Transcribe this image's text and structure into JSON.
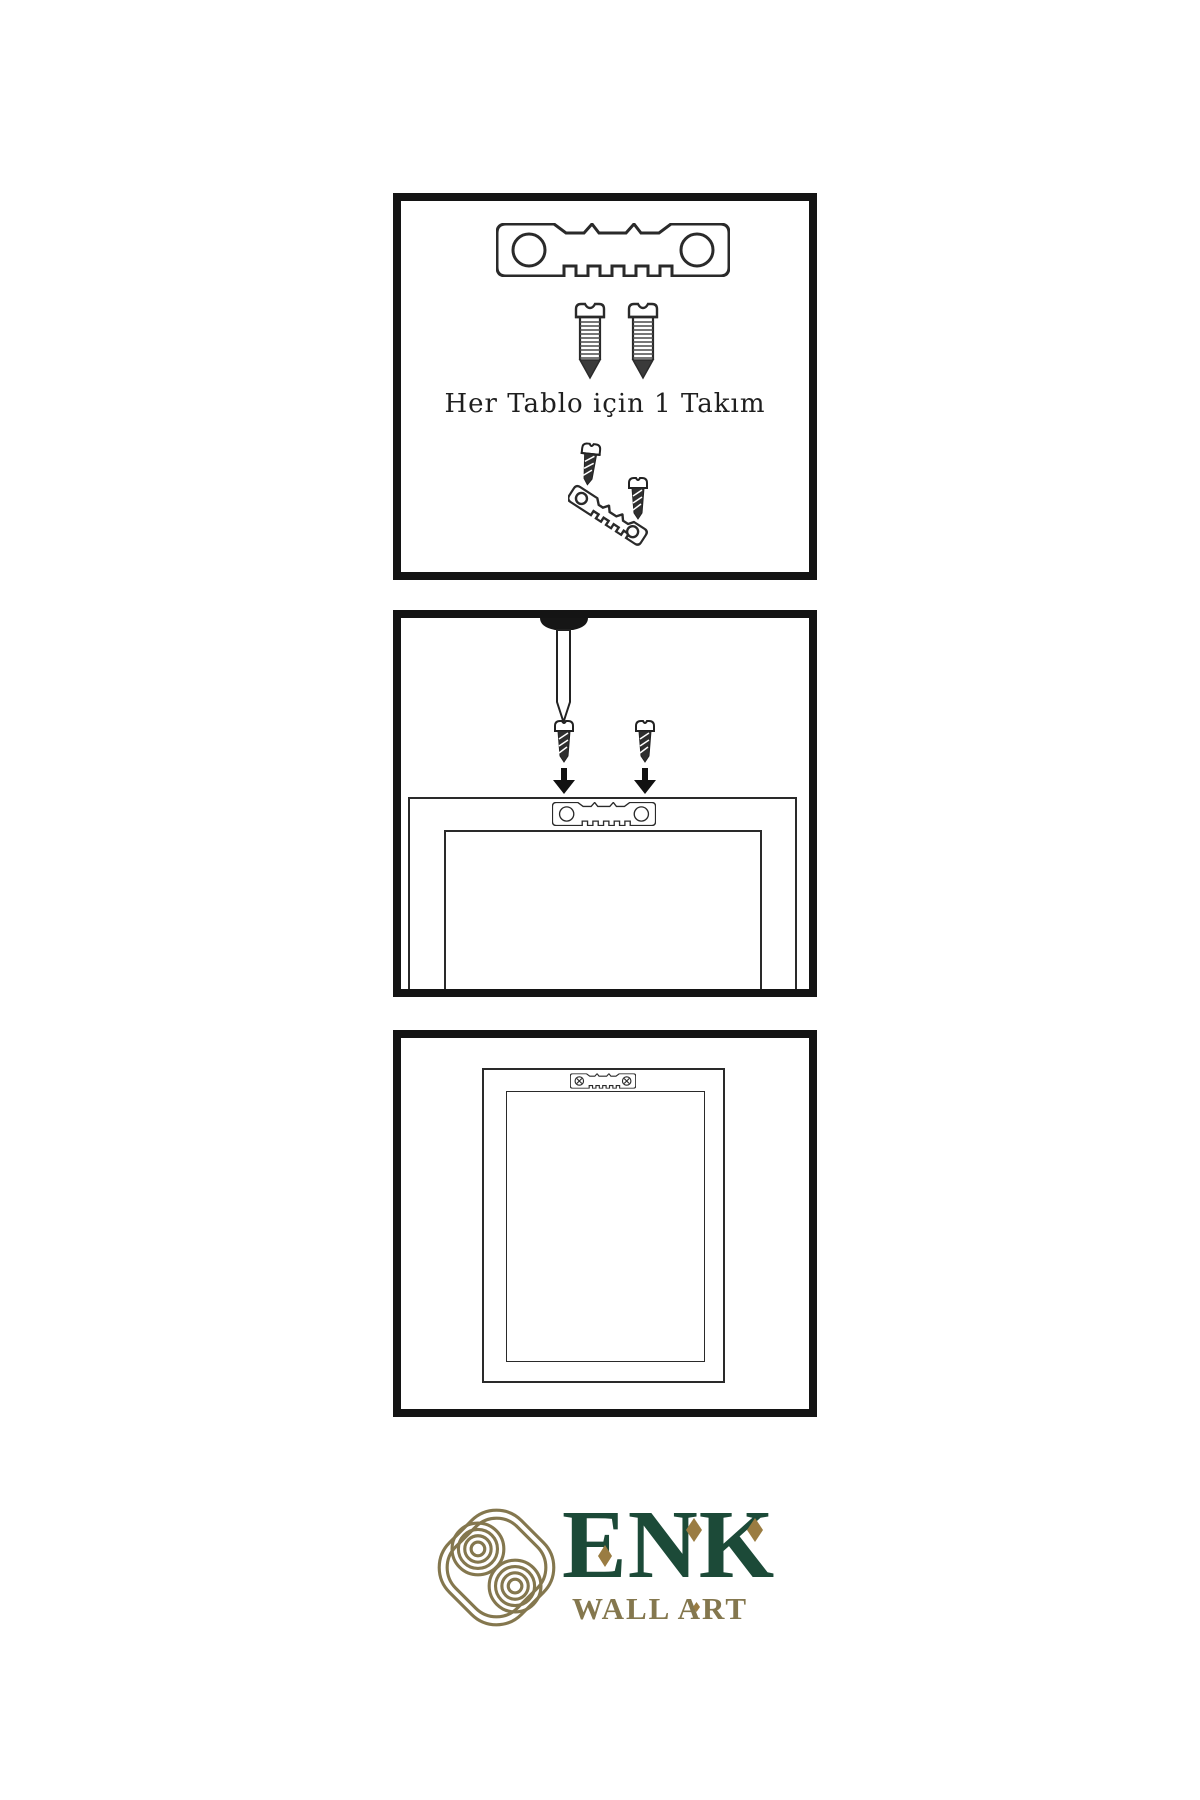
{
  "page": {
    "background": "#ffffff",
    "language": "tr"
  },
  "panels": {
    "kit": {
      "caption": "Her Tablo için 1 Takım",
      "items": [
        "sawtooth-hanger-bar",
        "two-screws",
        "hanger-with-screws-angled"
      ]
    },
    "mount": {
      "items": [
        "wall-nail",
        "two-screws-with-arrows",
        "frame-back-with-sawtooth-hanger"
      ]
    },
    "hang": {
      "items": [
        "framed-picture-with-mounted-hanger"
      ]
    }
  },
  "brand": {
    "name": "ENK",
    "subtitle": "WALL ART"
  },
  "colors": {
    "line": "#2a2a2a",
    "panel_border": "#141414",
    "screw_dark_fill": "#2f2f2f",
    "logo_green": "#1c4a38",
    "logo_gold": "#84774e",
    "accent_gold": "#9a7c42"
  }
}
